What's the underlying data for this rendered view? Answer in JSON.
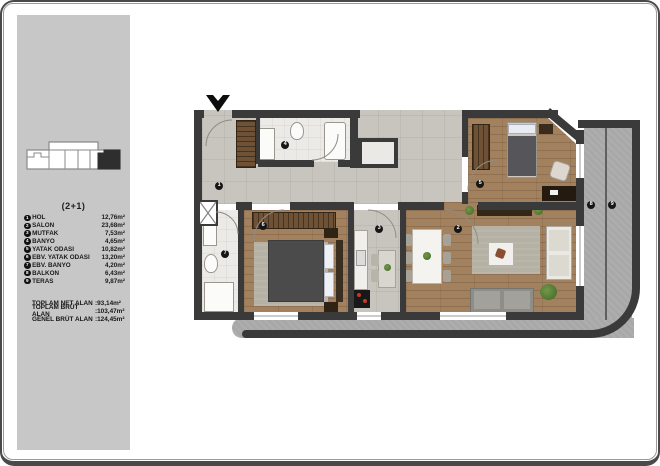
{
  "legend": {
    "title": "(2+1)",
    "rooms": [
      {
        "num": "1",
        "name": "HOL",
        "area": "12,76m²"
      },
      {
        "num": "2",
        "name": "SALON",
        "area": "23,68m²"
      },
      {
        "num": "3",
        "name": "MUTFAK",
        "area": "7,53m²"
      },
      {
        "num": "4",
        "name": "BANYO",
        "area": "4,65m²"
      },
      {
        "num": "5",
        "name": "YATAK ODASI",
        "area": "10,82m²"
      },
      {
        "num": "6",
        "name": "EBV. YATAK ODASI",
        "area": "13,20m²"
      },
      {
        "num": "7",
        "name": "EBV. BANYO",
        "area": "4,20m²"
      },
      {
        "num": "8",
        "name": "BALKON",
        "area": "6,43m²"
      },
      {
        "num": "9",
        "name": "TERAS",
        "area": "9,87m²"
      }
    ],
    "totals": [
      {
        "label": "TOPLAM NET ALAN",
        "value": ":93,14m²"
      },
      {
        "label": "TOPLAM BRÜT ALAN",
        "value": ":103,47m²"
      },
      {
        "label": "GENEL BRÜT ALAN",
        "value": ":124,45m²"
      }
    ]
  },
  "colors": {
    "wall": "#3a3a3a",
    "wood_floor": "#a2815f",
    "tile_floor": "#c8c5bf",
    "concrete": "#a8a8a8",
    "legend_panel": "#c7c7c7",
    "plant": "#55803a"
  }
}
